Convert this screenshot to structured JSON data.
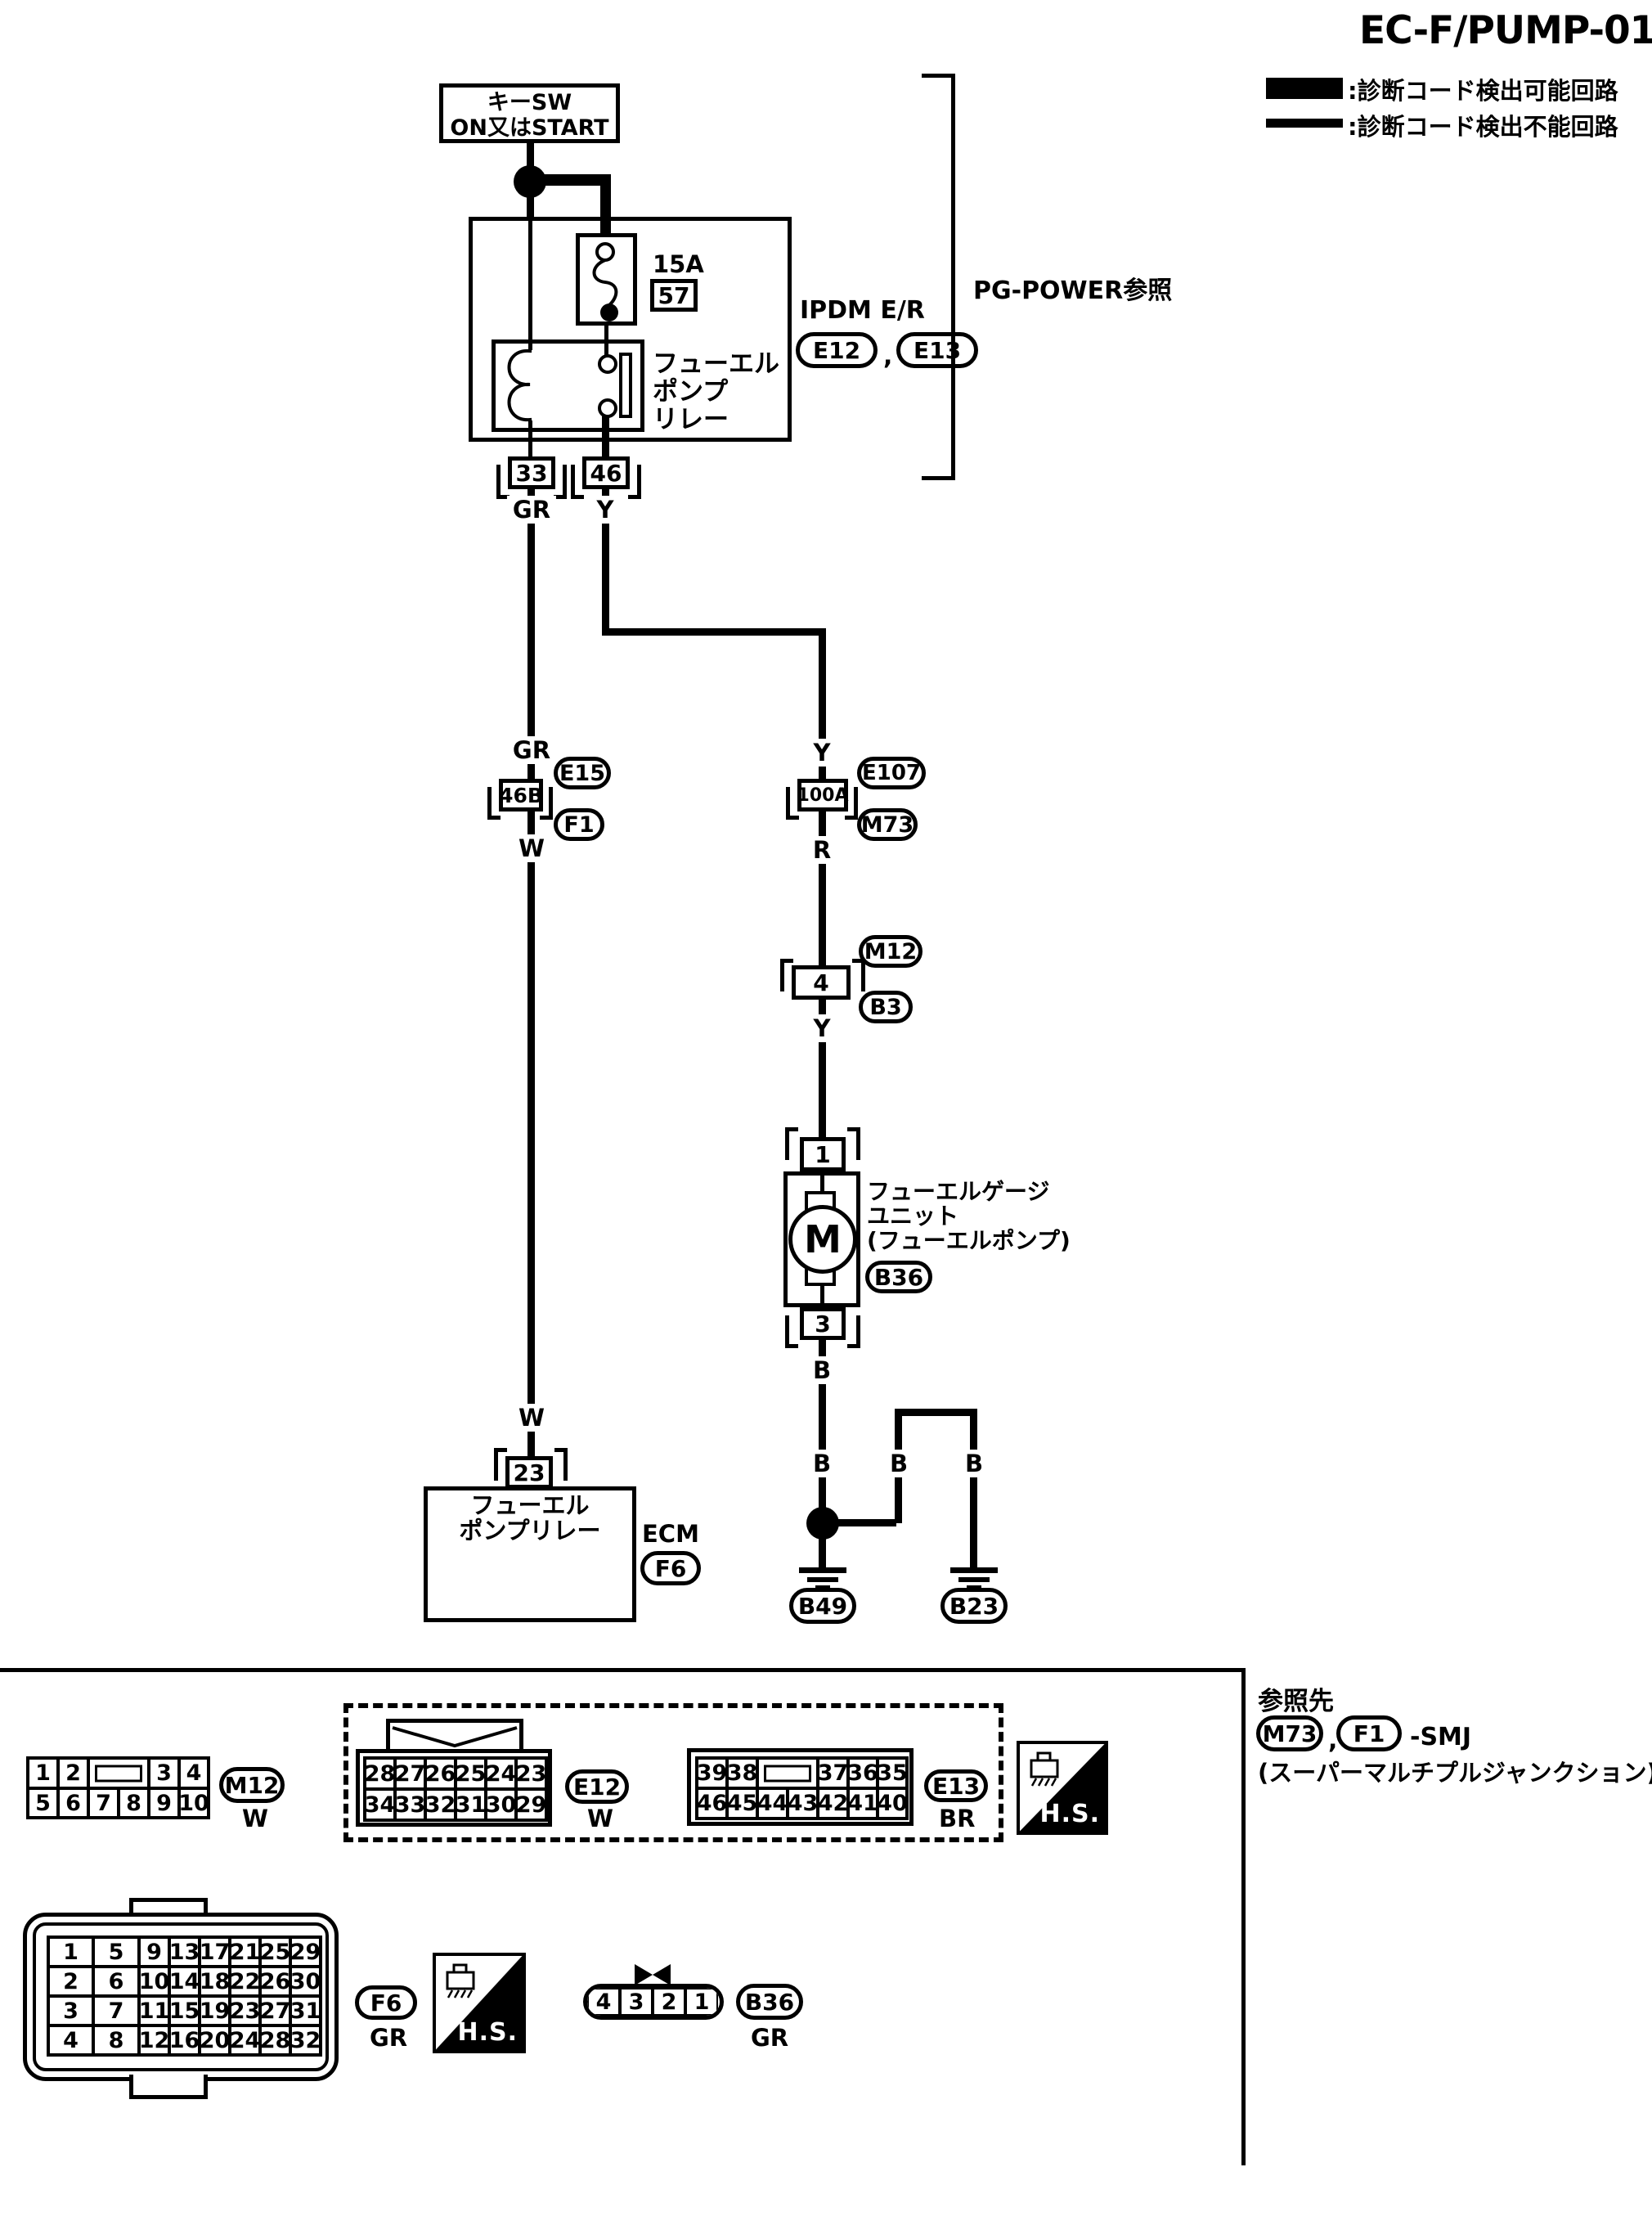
{
  "title": "EC-F/PUMP-01",
  "legend": {
    "detectable": ":診断コード検出可能回路",
    "not_detectable": ":診断コード検出不能回路"
  },
  "power_source": {
    "line1": "キーSW",
    "line2": "ON又はSTART"
  },
  "ipdm": {
    "fuse_rating": "15A",
    "fuse_number": "57",
    "name": "IPDM E/R",
    "conn_a": "E12",
    "comma": ",",
    "conn_b": "E13",
    "relay_l1": "フューエル",
    "relay_l2": "ポンプ",
    "relay_l3": "リレー",
    "pin_left": "33",
    "pin_right": "46",
    "pg_ref": "PG-POWER参照"
  },
  "left_path": {
    "color_1": "GR",
    "color_2": "GR",
    "smj": {
      "pin": "46B",
      "conn_top": "E15",
      "conn_bottom": "F1"
    },
    "color_3": "W",
    "color_4": "W",
    "ecm": {
      "pin": "23",
      "label_l1": "フューエル",
      "label_l2": "ポンプリレー",
      "name": "ECM",
      "conn": "F6"
    }
  },
  "right_path": {
    "color_1": "Y",
    "color_2": "Y",
    "smj": {
      "pin": "100A",
      "conn_top": "E107",
      "conn_bottom": "M73"
    },
    "color_3": "R",
    "body_conn": {
      "conn_top": "M12",
      "pin": "4",
      "conn_bottom": "B3"
    },
    "color_4": "Y",
    "pump": {
      "pin_top": "1",
      "motor": "M",
      "pin_bottom": "3",
      "label_l1": "フューエルゲージ",
      "label_l2": "ユニット",
      "label_l3": "(フューエルポンプ)",
      "conn": "B36"
    },
    "color_5": "B",
    "color_6": "B",
    "color_7": "B",
    "color_8": "B",
    "ground_a": "B49",
    "ground_b": "B23"
  },
  "footer": {
    "m12": {
      "row1": [
        "1",
        "2",
        "3",
        "4"
      ],
      "row2": [
        "5",
        "6",
        "7",
        "8",
        "9",
        "10"
      ],
      "name": "M12",
      "color": "W"
    },
    "e12": {
      "rows": [
        [
          "28",
          "27",
          "26",
          "25",
          "24",
          "23"
        ],
        [
          "34",
          "33",
          "32",
          "31",
          "30",
          "29"
        ]
      ],
      "name": "E12",
      "color": "W"
    },
    "e13": {
      "row1": [
        "39",
        "38",
        "37",
        "36",
        "35"
      ],
      "row2": [
        "46",
        "45",
        "44",
        "43",
        "42",
        "41",
        "40"
      ],
      "name": "E13",
      "color": "BR"
    },
    "f6": {
      "rows": [
        [
          "1",
          "5",
          "9",
          "13",
          "17",
          "21",
          "25",
          "29"
        ],
        [
          "2",
          "6",
          "10",
          "14",
          "18",
          "22",
          "26",
          "30"
        ],
        [
          "3",
          "7",
          "11",
          "15",
          "19",
          "23",
          "27",
          "31"
        ],
        [
          "4",
          "8",
          "12",
          "16",
          "20",
          "24",
          "28",
          "32"
        ]
      ],
      "name": "F6",
      "color": "GR"
    },
    "b36": {
      "cells": [
        "4",
        "3",
        "2",
        "1"
      ],
      "name": "B36",
      "color": "GR"
    },
    "hs": "H.S.",
    "ref": {
      "title": "参照先",
      "conn_1": "M73",
      "comma": ",",
      "conn_2": "F1",
      "suffix": "-SMJ",
      "note": "(スーパーマルチプルジャンクション)"
    }
  }
}
